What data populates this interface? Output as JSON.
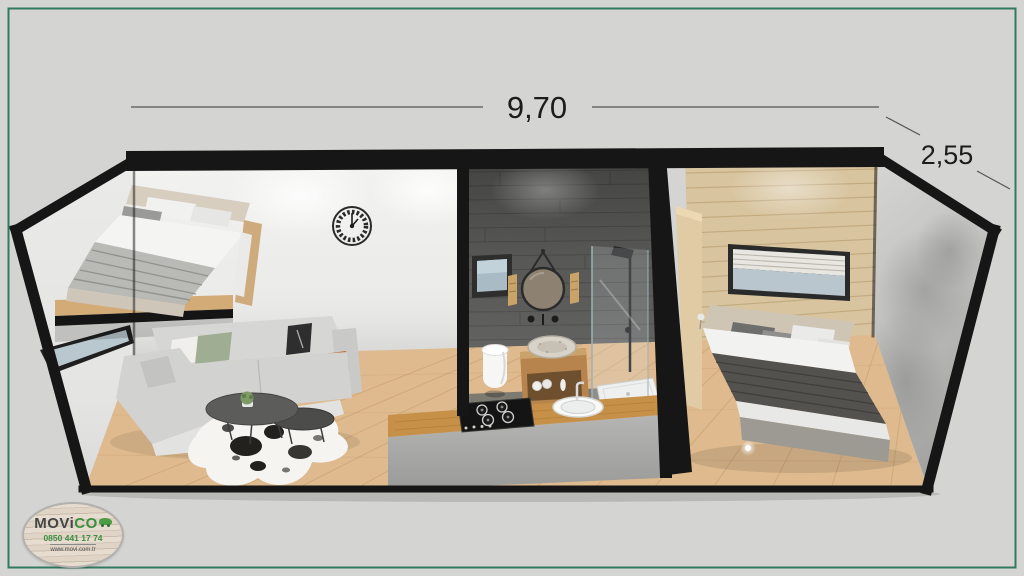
{
  "dimensions": {
    "width_label": "9,70",
    "depth_label": "2,55"
  },
  "logo": {
    "brand_part1": "MOVi",
    "brand_part2": "CO",
    "phone": "0850 441 17 74",
    "website": "www.movi.com.tr",
    "brand_green": "#3e8e41"
  },
  "palette": {
    "frame_green": "#337a62",
    "background_grey": "#d4d4d2",
    "trim_black": "#161616",
    "living_wall_white": "#ececea",
    "tile_dark_grey": "#5d5d5b",
    "wood_wall": "#d8c5a0",
    "floor_wood": "#deba8e",
    "island_wood_top": "#c79048",
    "island_front_grey": "#a9a9a7",
    "sofa_grey": "#d2d2d0",
    "bed_blanket_dark": "#54524f",
    "left_wall": "#e5e5e3",
    "right_wall": "#bcbcba"
  }
}
